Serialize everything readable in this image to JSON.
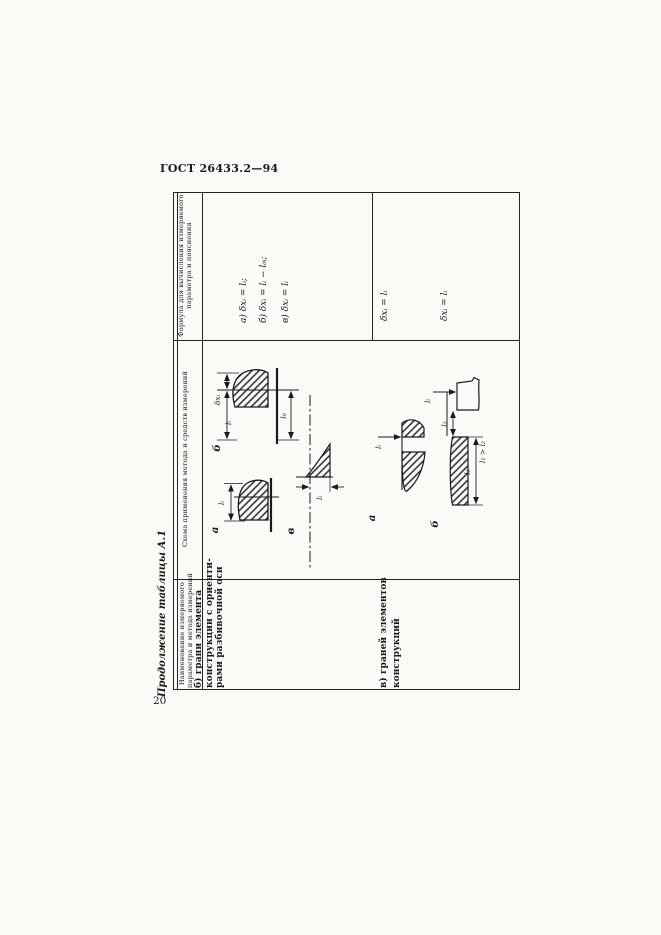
{
  "page": {
    "standard_code": "ГОСТ 26433.2—94",
    "page_number": "20",
    "table_title": "Продолжение таблицы А.1"
  },
  "table": {
    "col_name": {
      "line1": "Наименование измеряемого",
      "line2": "параметра и метода измерений"
    },
    "col_scheme": "Схема применения метода и средств измерений",
    "col_formula": {
      "line1": "Формула для вычисления измеряемого",
      "line2": "параметра и пояснения"
    },
    "row1": {
      "name": {
        "line1": "б) грани элемента",
        "line2": "конструкции с ориенти-",
        "line3": "рами разбивочной оси"
      },
      "formulas": {
        "a": "а) δxᵢ = lᵢ;",
        "b": "б) δxᵢ = lᵢ − l₀ᵢ;",
        "v": "в) δxᵢ = lᵢ"
      },
      "scheme_labels": {
        "a": {
          "letter": "а",
          "li": "lᵢ"
        },
        "b": {
          "letter": "б",
          "dx": "δxᵢ",
          "li": "lᵢ",
          "l0": "l₀"
        },
        "v": {
          "letter": "в",
          "li": "lᵢ"
        }
      }
    },
    "row2": {
      "name": {
        "line1": "в) граней элементов",
        "line2": "конструкций"
      },
      "formulas": {
        "a": "δxᵢ = lᵢ",
        "b": "δxᵢ = lᵢ"
      },
      "scheme_labels": {
        "a": {
          "letter": "а",
          "li": "lᵢ"
        },
        "b": {
          "letter": "б",
          "li": "lᵢ",
          "l2": "l₂",
          "l1": "l₁",
          "rel": "l₁ > l₂"
        }
      }
    }
  }
}
